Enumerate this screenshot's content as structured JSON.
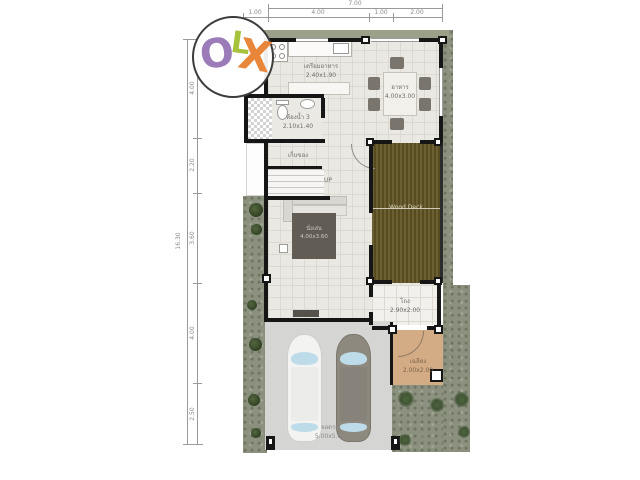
{
  "watermark": {
    "letters": [
      {
        "char": "O",
        "color": "#9b7bb8"
      },
      {
        "char": "L",
        "color": "#a6c23c"
      },
      {
        "char": "X",
        "color": "#e8873a"
      }
    ]
  },
  "dimensions": {
    "top": {
      "total": "7.00",
      "segments": [
        "1.00",
        "4.00",
        "1.00",
        "2.00"
      ]
    },
    "left": {
      "total": "16.30",
      "segments": [
        "4.00",
        "2.20",
        "3.60",
        "4.00",
        "2.50"
      ]
    }
  },
  "rooms": {
    "kitchen": {
      "name": "เตรียมอาหาร",
      "size": "2.40x1.90"
    },
    "dining": {
      "name": "อาหาร",
      "size": "4.00x3.00"
    },
    "bathroom": {
      "name": "ห้องน้ำ 3",
      "size": "2.10x1.40"
    },
    "storage": {
      "name": "เก็บของ"
    },
    "stairs": {
      "label": "UP"
    },
    "living": {
      "name": "นั่งเล่น",
      "size": "4.00x3.60"
    },
    "deck": {
      "name": "Wood Deck"
    },
    "hall": {
      "name": "โถง",
      "size": "2.90x2.00"
    },
    "porch": {
      "name": "เฉลียง",
      "size": "2.00x2.00"
    },
    "garage": {
      "name": "จอดรถ",
      "size": "5.00x5.00"
    }
  },
  "colors": {
    "wall": "#161616",
    "grass": "#8b917e",
    "floor_tile": "#eae8e2",
    "wood_deck": "#6c5f31",
    "porch_tan": "#d3ac86",
    "garage_gray": "#d5d5d4",
    "dimension_gray": "#8a8a8a"
  }
}
